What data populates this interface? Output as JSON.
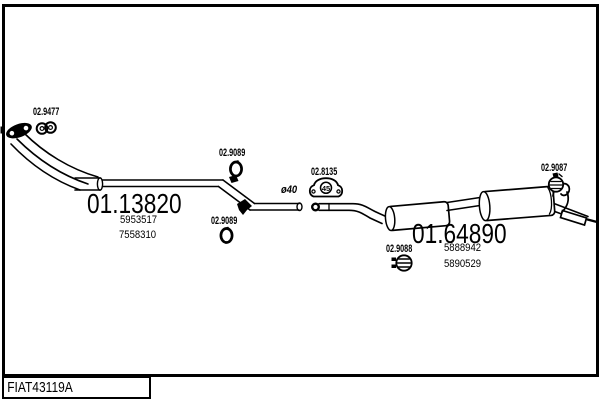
{
  "canvas": {
    "background": "#ffffff",
    "line_color": "#000000"
  },
  "footer": {
    "drawing_number": "FIAT43119A"
  },
  "parts": {
    "front_clamp": {
      "code": "02.9477",
      "icon": "double-ring-clamp-icon"
    },
    "front_pipe": {
      "code": "01.13820",
      "oem_numbers": [
        "5953517",
        "7558310"
      ]
    },
    "hanger_ring_upper": {
      "code": "02.9089",
      "icon": "rubber-ring-icon"
    },
    "hanger_ring_lower": {
      "code": "02.9089",
      "icon": "rubber-ring-icon"
    },
    "gasket": {
      "code": "02.8135",
      "size_marking": "45",
      "icon": "flange-gasket-icon"
    },
    "pipe_diameter_note": "ø40",
    "rear_silencer": {
      "code": "01.64890",
      "oem_numbers": [
        "5888942",
        "5890529"
      ]
    },
    "center_clamp": {
      "code": "02.9088",
      "icon": "band-clamp-icon"
    },
    "tail_clamp": {
      "code": "02.9087",
      "icon": "band-clamp-icon"
    }
  }
}
